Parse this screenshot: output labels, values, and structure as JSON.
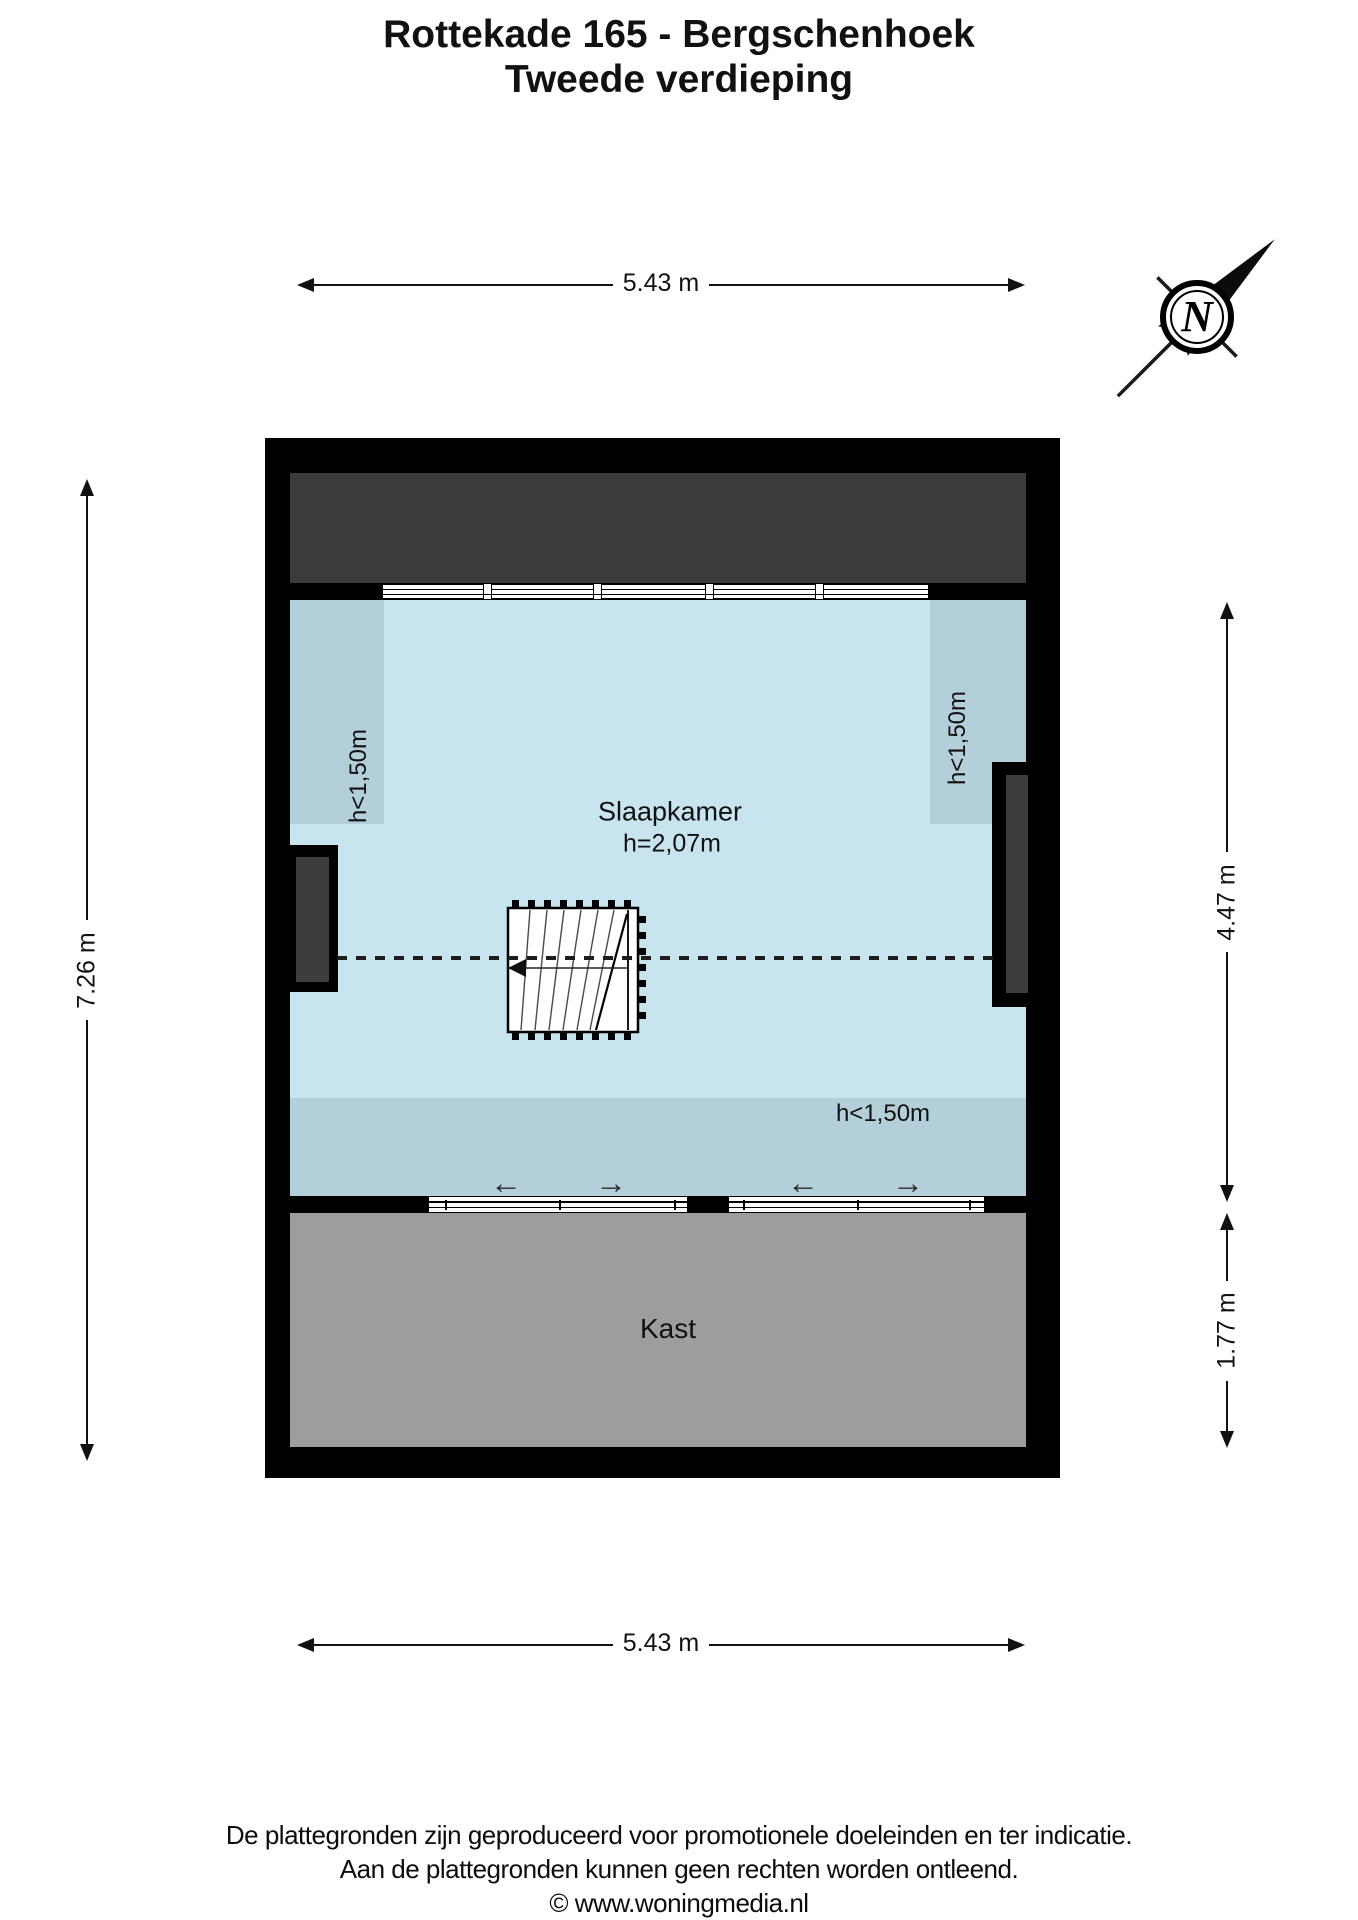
{
  "title": {
    "line1": "Rottekade 165 - Bergschenhoek",
    "line2": "Tweede verdieping"
  },
  "compass": {
    "letter": "N"
  },
  "dimensions": {
    "top": "5.43 m",
    "bottom": "5.43 m",
    "left": "7.26 m",
    "right_upper": "4.47 m",
    "right_lower": "1.77 m"
  },
  "rooms": {
    "bedroom": {
      "name": "Slaapkamer",
      "height_label": "h=2,07m"
    },
    "closet": {
      "name": "Kast"
    },
    "low_left": "h<1,50m",
    "low_right": "h<1,50m",
    "low_bottom": "h<1,50m"
  },
  "footer": {
    "line1": "De plattegronden zijn geproduceerd voor promotionele doeleinden en ter indicatie.",
    "line2": "Aan de plattegronden kunnen geen rechten worden ontleend.",
    "line3": "© www.woningmedia.nl"
  },
  "colors": {
    "wall": "#000000",
    "roof_area": "#3b3b3b",
    "room_blue": "#c7e4ef",
    "low_height_blue": "#b3cfda",
    "closet_gray": "#9d9d9d",
    "door_panel_gray": "#3d3d3d"
  }
}
